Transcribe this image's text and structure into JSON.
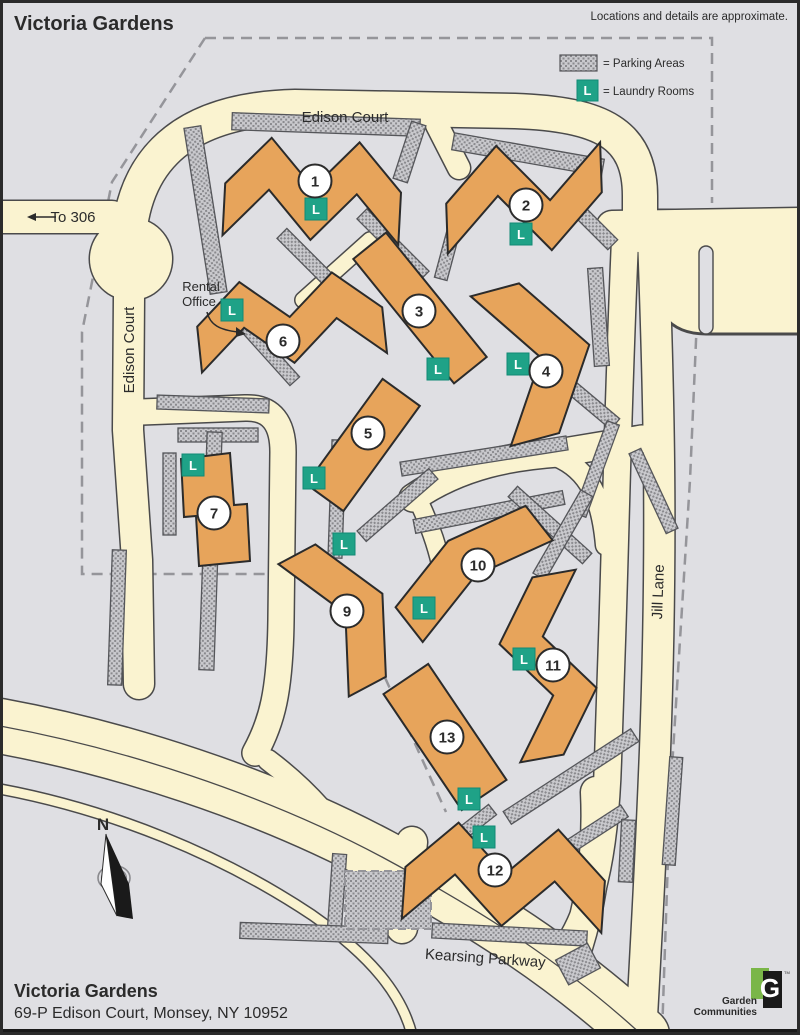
{
  "header": {
    "title": "Victoria Gardens",
    "disclaimer": "Locations and details are approximate."
  },
  "legend": {
    "parking_label": "= Parking Areas",
    "laundry_label": "= Laundry Rooms",
    "laundry_symbol": "L"
  },
  "rental_office": {
    "line1": "Rental",
    "line2": "Office"
  },
  "compass": {
    "north_label": "N"
  },
  "footer": {
    "name": "Victoria Gardens",
    "address": "69-P Edison Court, Monsey, NY 10952"
  },
  "logo": {
    "letter": "G",
    "tm": "TM",
    "line1": "Garden",
    "line2": "Communities",
    "green": "#7AB648",
    "black": "#1A1A1A"
  },
  "colors": {
    "background": "#DFDFE3",
    "road": "#FAF3D0",
    "road_casing": "#4A4A4B",
    "building": "#E7A45B",
    "building_outline": "#2B2B2B",
    "laundry": "#1FA287",
    "laundry_edge": "#128A74",
    "boundary": "#95959A",
    "hatch_bg": "#C9C9CD",
    "hatch_dot": "#8A8A8E",
    "hatch_edge": "#55565A"
  },
  "map": {
    "boundary_paths": [
      "M205,38 L712,38 L712,203",
      "M700,248 L690,480 L670,800 L662,1035",
      "M205,38 L112,182 L82,332 L82,574 L338,574 L446,812"
    ],
    "roads": [
      {
        "name": "road-edison-court-top",
        "d": "M128,262 C126,170 172,110 295,107 L515,111 C602,114 640,134 640,196 L640,235",
        "w": 34
      },
      {
        "name": "road-to-306",
        "d": "M0,217 L112,217",
        "w": 32
      },
      {
        "name": "road-top-right",
        "d": "M612,226 L800,223",
        "w": 30
      },
      {
        "name": "road-inner-right",
        "d": "M625,240 C618,400 616,520 612,640 L608,760 C605,860 590,915 565,950",
        "w": 26
      },
      {
        "name": "road-jill-lane",
        "d": "M653,237 C660,420 662,560 655,750 C650,880 645,960 641,1035",
        "w": 30
      },
      {
        "name": "road-edison-court-left",
        "d": "M129,296 L128,430 L137,560 L139,684",
        "w": 30
      },
      {
        "name": "road-interior-west",
        "d": "M141,412 L245,408 C272,407 283,424 283,452 L281,620 C280,692 272,722 255,753",
        "w": 25
      },
      {
        "name": "road-interior-diagonal",
        "d": "M413,498 C462,464 515,456 558,453 L642,439",
        "w": 27
      },
      {
        "name": "road-diag-branch-east",
        "d": "M556,456 C590,470 602,500 606,545",
        "w": 20
      },
      {
        "name": "road-diag-branch-west",
        "d": "M416,496 C428,520 436,542 441,564",
        "w": 18
      },
      {
        "name": "road-walk-b6",
        "d": "M303,300 L370,240",
        "w": 15
      },
      {
        "name": "road-stub-top",
        "d": "M437,125 L459,168",
        "w": 22
      },
      {
        "name": "road-kearsing-parkway",
        "d": "M0,726 C120,748 262,793 382,857 C482,911 562,962 642,1035",
        "w": 54
      },
      {
        "name": "road-kearsing-south-lane",
        "d": "M0,789 C112,810 222,855 312,915 C372,957 402,995 412,1035",
        "w": 9
      },
      {
        "name": "road-cul-de-sac",
        "d": "M268,760 C304,787 332,818 353,851",
        "w": 20
      },
      {
        "name": "road-driveway-b12",
        "d": "M402,928 L412,842",
        "w": 30
      },
      {
        "name": "road-b12-east",
        "d": "M596,792 C599,852 591,902 577,947",
        "w": 30
      }
    ],
    "kearsing_median": "M0,726 C120,748 262,793 382,857 C482,911 562,962 642,1035",
    "roundabout": {
      "cx": 131,
      "cy": 259,
      "r": 41
    },
    "pocket": "M640,210 L800,210 L800,334 L706,334 C668,334 652,310 650,268 L648,238 Z",
    "island": {
      "x": 699,
      "y": 246,
      "w": 14,
      "h": 88,
      "r": 7
    },
    "parking_areas": [
      [
        232,
        116,
        188,
        17,
        2
      ],
      [
        452,
        146,
        152,
        17,
        10
      ],
      [
        197,
        126,
        17,
        168,
        -9
      ],
      [
        402,
        122,
        15,
        60,
        18
      ],
      [
        268,
        260,
        95,
        14,
        45
      ],
      [
        349,
        238,
        88,
        14,
        45
      ],
      [
        228,
        345,
        80,
        13,
        48
      ],
      [
        443,
        212,
        13,
        68,
        15
      ],
      [
        553,
        213,
        70,
        14,
        45
      ],
      [
        591,
        268,
        15,
        98,
        -4
      ],
      [
        549,
        393,
        75,
        14,
        40
      ],
      [
        157,
        397,
        112,
        14,
        2
      ],
      [
        178,
        428,
        80,
        14,
        0
      ],
      [
        203,
        432,
        15,
        238,
        2
      ],
      [
        110,
        550,
        14,
        135,
        2
      ],
      [
        163,
        453,
        13,
        82,
        0
      ],
      [
        330,
        440,
        14,
        118,
        2
      ],
      [
        400,
        449,
        168,
        14,
        -9
      ],
      [
        413,
        505,
        152,
        14,
        -11
      ],
      [
        500,
        518,
        100,
        14,
        42
      ],
      [
        590,
        420,
        13,
        98,
        20
      ],
      [
        647,
        447,
        13,
        88,
        -25
      ],
      [
        350,
        498,
        95,
        14,
        -41
      ],
      [
        556,
        487,
        14,
        96,
        30
      ],
      [
        495,
        769,
        152,
        15,
        -33
      ],
      [
        516,
        836,
        118,
        14,
        -33
      ],
      [
        666,
        757,
        13,
        108,
        4
      ],
      [
        330,
        854,
        14,
        76,
        4
      ],
      [
        240,
        925,
        148,
        16,
        2
      ],
      [
        432,
        927,
        155,
        15,
        3
      ],
      [
        620,
        820,
        14,
        62,
        3
      ],
      [
        560,
        950,
        36,
        28,
        -28
      ],
      [
        455,
        816,
        42,
        13,
        -38
      ]
    ],
    "parking_block_dashed": {
      "x": 345,
      "y": 871,
      "w": 86,
      "h": 58
    },
    "buildings": [
      {
        "number": "1",
        "cx": 313,
        "cy": 190,
        "angle": 3,
        "len": 176,
        "w": 52,
        "teeth": 4,
        "amp": 24,
        "start": 1,
        "label": [
          315,
          181
        ],
        "laundry": [
          316,
          209
        ]
      },
      {
        "number": "2",
        "cx": 524,
        "cy": 198,
        "angle": -2,
        "len": 156,
        "w": 50,
        "teeth": 3,
        "amp": 28,
        "start": 1,
        "label": [
          526,
          205
        ],
        "laundry": [
          521,
          234
        ]
      },
      {
        "number": "3",
        "cx": 420,
        "cy": 308,
        "angle": 51,
        "len": 160,
        "w": 42,
        "teeth": 0,
        "amp": 0,
        "start": 1,
        "label": [
          419,
          311
        ],
        "laundry": [
          438,
          369
        ]
      },
      {
        "number": "4",
        "cx": 540,
        "cy": 358,
        "angle": 75,
        "len": 155,
        "w": 50,
        "teeth": 2,
        "amp": 26,
        "start": 1,
        "label": [
          546,
          371
        ],
        "laundry": [
          518,
          364
        ]
      },
      {
        "number": "5",
        "cx": 363,
        "cy": 445,
        "angle": 126,
        "len": 130,
        "w": 46,
        "teeth": 0,
        "amp": 0,
        "start": 1,
        "label": [
          368,
          433
        ],
        "laundry": [
          314,
          478
        ]
      },
      {
        "number": "6",
        "cx": 290,
        "cy": 320,
        "angle": -6,
        "len": 186,
        "w": 46,
        "teeth": 4,
        "amp": 20,
        "start": 1,
        "label": [
          283,
          341
        ],
        "laundry": [
          232,
          310
        ]
      },
      {
        "number": "7",
        "points": "181,459 230,453 234,505 247,504 250,561 199,566 196,516 184,517",
        "label": [
          214,
          513
        ],
        "laundry": [
          193,
          465
        ]
      },
      {
        "number": "9",
        "cx": 348,
        "cy": 612,
        "angle": 62,
        "len": 150,
        "w": 42,
        "teeth": 2,
        "amp": 18,
        "start": 1,
        "label": [
          347,
          611
        ],
        "laundry": [
          344,
          544
        ]
      },
      {
        "number": "10",
        "cx": 468,
        "cy": 566,
        "angle": -38,
        "len": 165,
        "w": 44,
        "teeth": 2,
        "amp": 10,
        "start": 1,
        "label": [
          478,
          565
        ],
        "laundry": [
          424,
          608
        ]
      },
      {
        "number": "11",
        "cx": 548,
        "cy": 666,
        "angle": 80,
        "len": 180,
        "w": 44,
        "teeth": 3,
        "amp": 22,
        "start": -1,
        "label": [
          553,
          665
        ],
        "laundry": [
          524,
          659
        ]
      },
      {
        "number": "12",
        "cx": 505,
        "cy": 876,
        "angle": 4,
        "len": 200,
        "w": 52,
        "teeth": 4,
        "amp": 24,
        "start": 1,
        "label": [
          495,
          870
        ],
        "laundry": [
          484,
          837
        ]
      },
      {
        "number": "13",
        "cx": 445,
        "cy": 737,
        "angle": 56,
        "len": 140,
        "w": 54,
        "teeth": 0,
        "amp": 0,
        "start": 1,
        "label": [
          447,
          737
        ],
        "laundry": [
          469,
          799
        ]
      }
    ],
    "road_labels": [
      {
        "name": "label-edison-court-top",
        "text": "Edison Court",
        "x": 345,
        "y": 122,
        "rotate": 0
      },
      {
        "name": "label-edison-court-left",
        "text": "Edison Court",
        "x": 134,
        "y": 350,
        "rotate": -90
      },
      {
        "name": "label-jill-lane",
        "text": "Jill Lane",
        "x": 663,
        "y": 592,
        "rotate": -88
      },
      {
        "name": "label-kearsing-parkway",
        "text": "Kearsing Parkway",
        "x": 485,
        "y": 963,
        "rotate": 4
      },
      {
        "name": "label-to-306",
        "text": "To 306",
        "x": 73,
        "y": 222,
        "rotate": 0
      }
    ]
  }
}
